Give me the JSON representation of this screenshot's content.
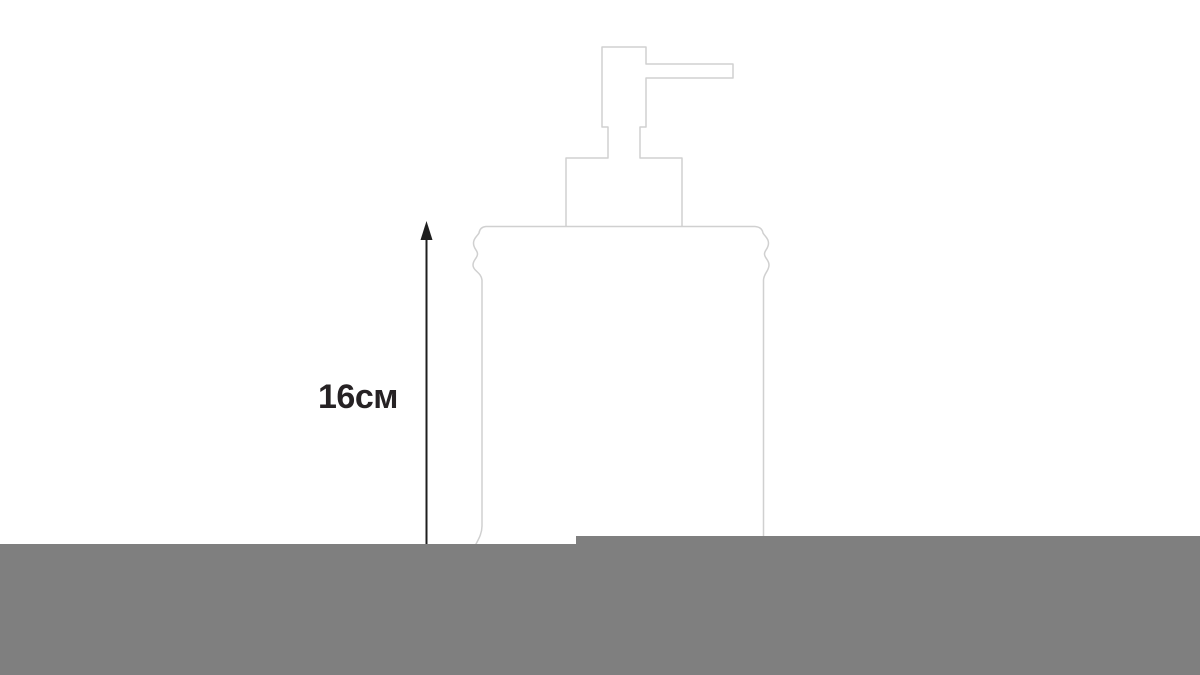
{
  "diagram": {
    "subject": "soap-dispenser-line-drawing",
    "dimension": {
      "label": "16см",
      "value": 16,
      "unit": "см"
    }
  },
  "colors": {
    "background": "#ffffff",
    "outline": "#d0d0d0",
    "arrow": "#1f1f1f",
    "label_text": "#262224",
    "band": "#7f7f7f"
  }
}
